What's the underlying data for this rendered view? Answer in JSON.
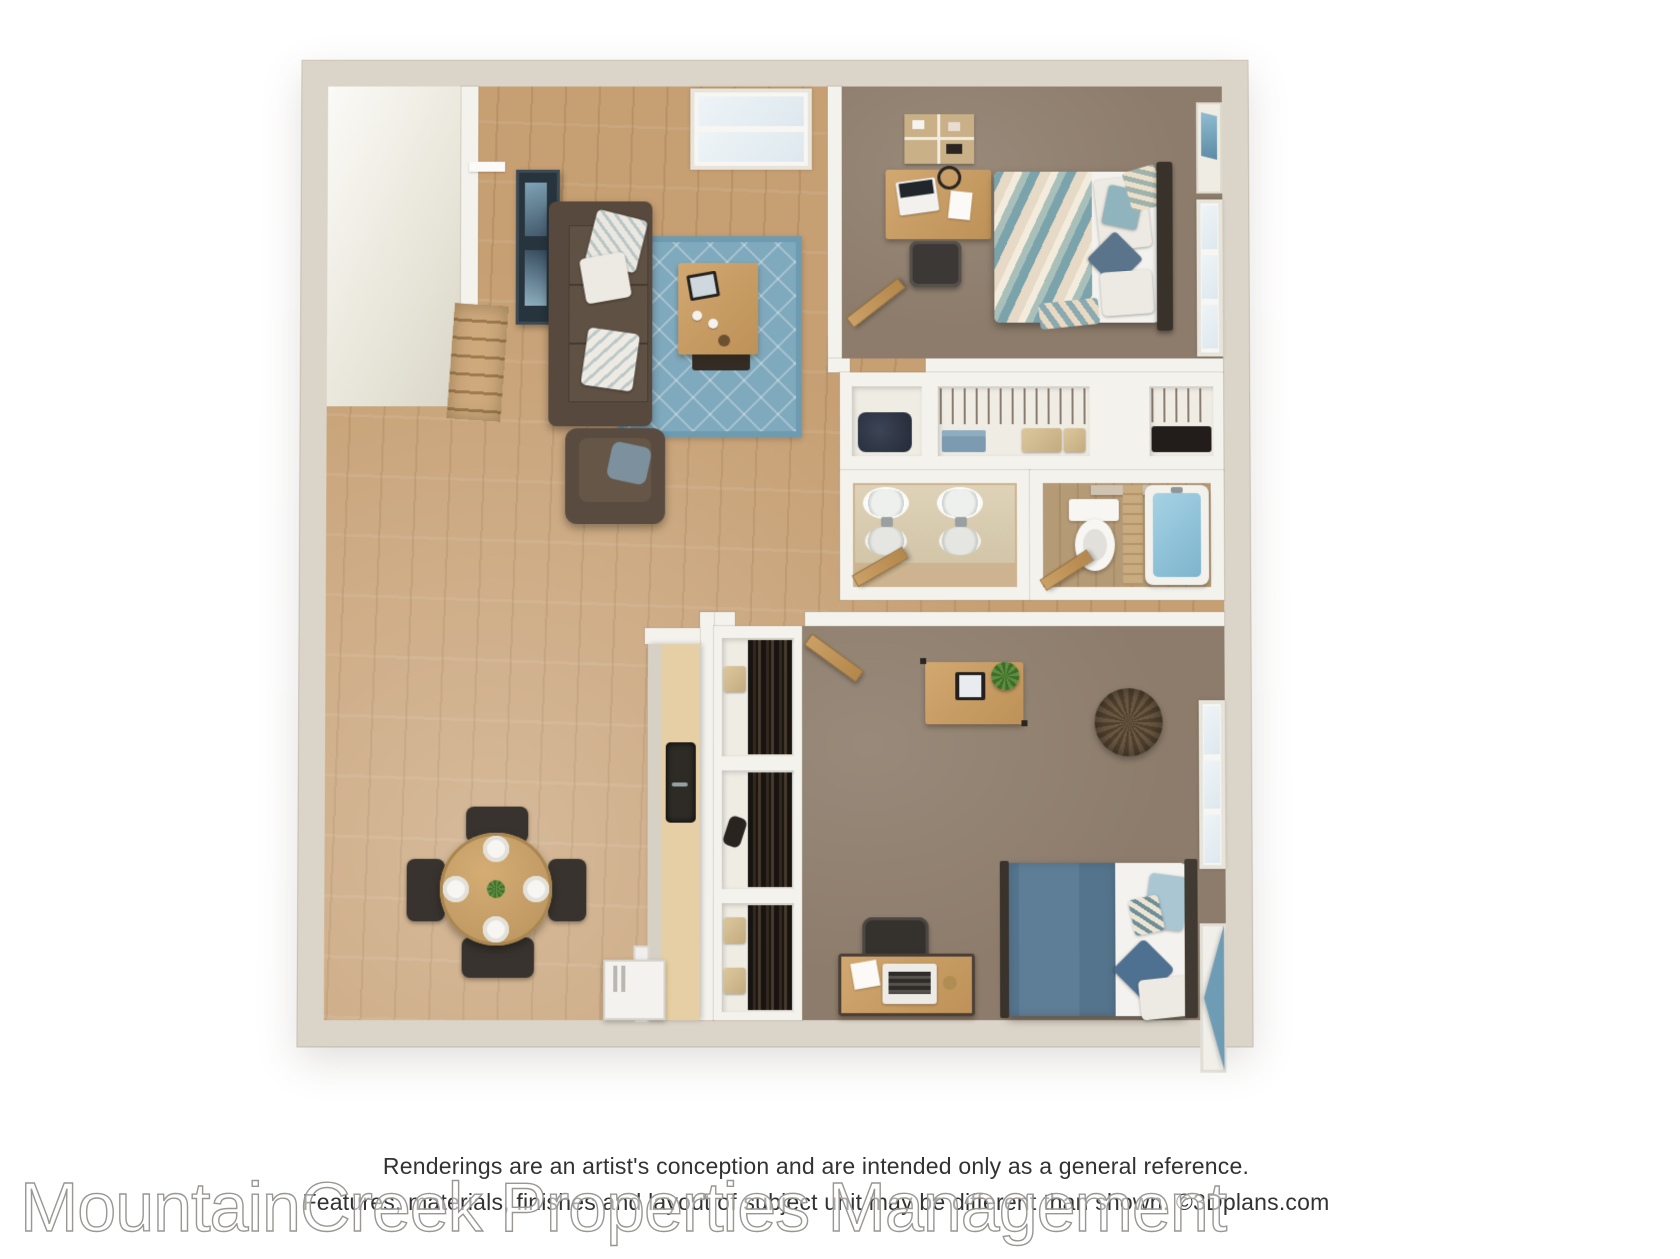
{
  "watermark": {
    "text": "MountainCreek Properties Management"
  },
  "disclaimer": {
    "line1": "Renderings are an artist's conception and are intended only as a general reference.",
    "line2": "Features, materials, finishes and layout of subject unit may be different than shown. ©3Dplans.com"
  },
  "floorplan": {
    "type": "3d-rendered-apartment-floor-plan",
    "rooms": [
      "living-room",
      "stairwell",
      "bedroom-1",
      "hall-closets",
      "vanity-bathroom",
      "bathroom",
      "bedroom-2",
      "kitchen",
      "dining-area",
      "hallway"
    ],
    "colors": {
      "background": "#ffffff",
      "outer_wall": "#dbd5c9",
      "inner_wall": "#f4f2ed",
      "hardwood": "#c69f73",
      "carpet": "#8d7c6b",
      "rug_blue": "#7fa9bd",
      "sofa_brown": "#57493d",
      "furniture_wood": "#c49a62",
      "accent_blue": "#6f9cb5",
      "tub_water": "#8fc3dc"
    }
  }
}
